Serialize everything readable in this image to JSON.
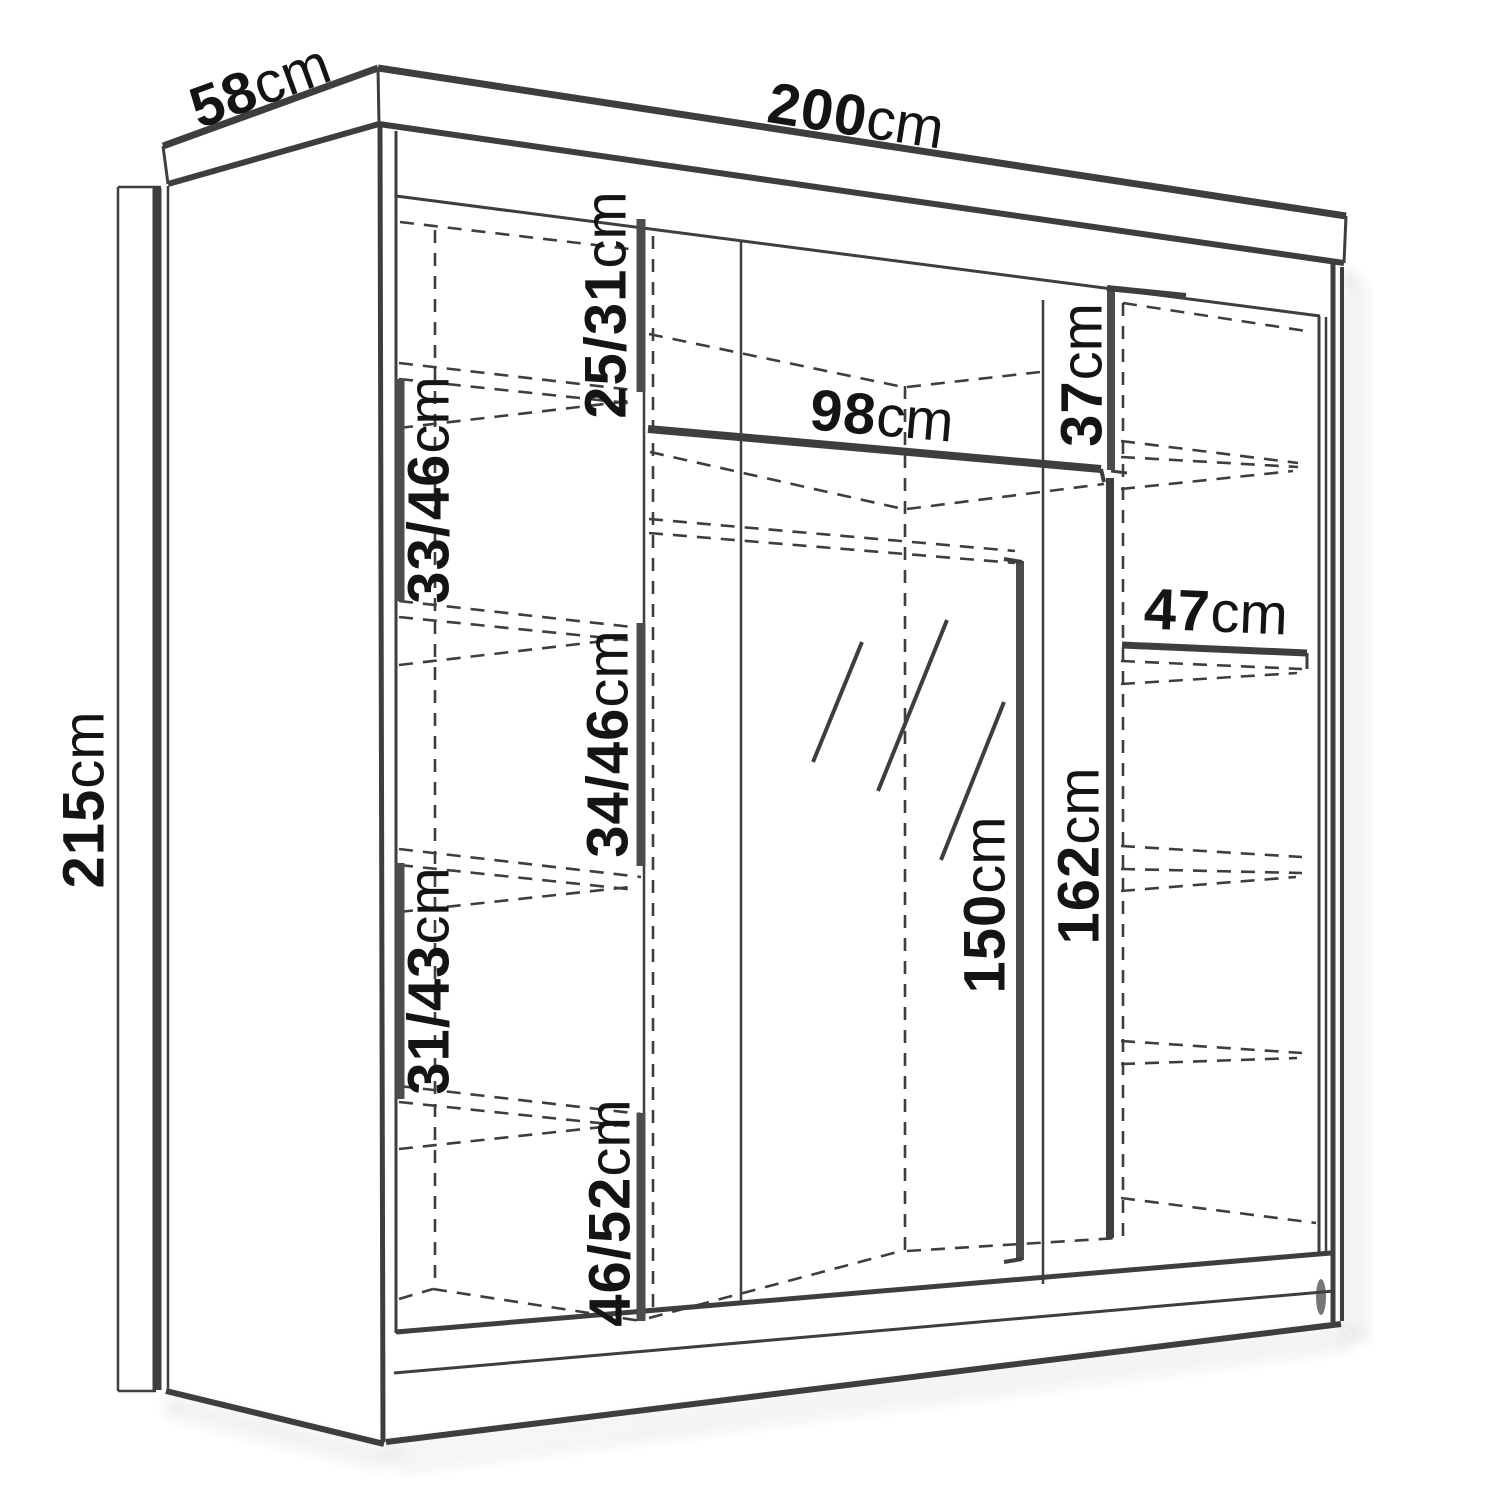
{
  "diagram": {
    "title": "Sliding wardrobe dimension diagram",
    "unit": "cm",
    "colors": {
      "line": "#3e3e3e",
      "bar": "#4c4c4c",
      "text": "#141414",
      "background": "#ffffff",
      "shadow": "#a8a8a8"
    },
    "overall": {
      "depth": {
        "value": "58",
        "unit": "cm"
      },
      "width": {
        "value": "200",
        "unit": "cm"
      },
      "height": {
        "value": "215",
        "unit": "cm"
      }
    },
    "left_shelves": [
      {
        "value": "25/31",
        "unit": "cm"
      },
      {
        "value": "33/46",
        "unit": "cm"
      },
      {
        "value": "34/46",
        "unit": "cm"
      },
      {
        "value": "31/43",
        "unit": "cm"
      },
      {
        "value": "46/52",
        "unit": "cm"
      }
    ],
    "middle": {
      "shelf_width": {
        "value": "98",
        "unit": "cm"
      },
      "mirror_height": {
        "value": "150",
        "unit": "cm"
      },
      "interior_height": {
        "value": "162",
        "unit": "cm"
      }
    },
    "right": {
      "top_compartment_height": {
        "value": "37",
        "unit": "cm"
      },
      "shelf_width": {
        "value": "47",
        "unit": "cm"
      }
    }
  }
}
